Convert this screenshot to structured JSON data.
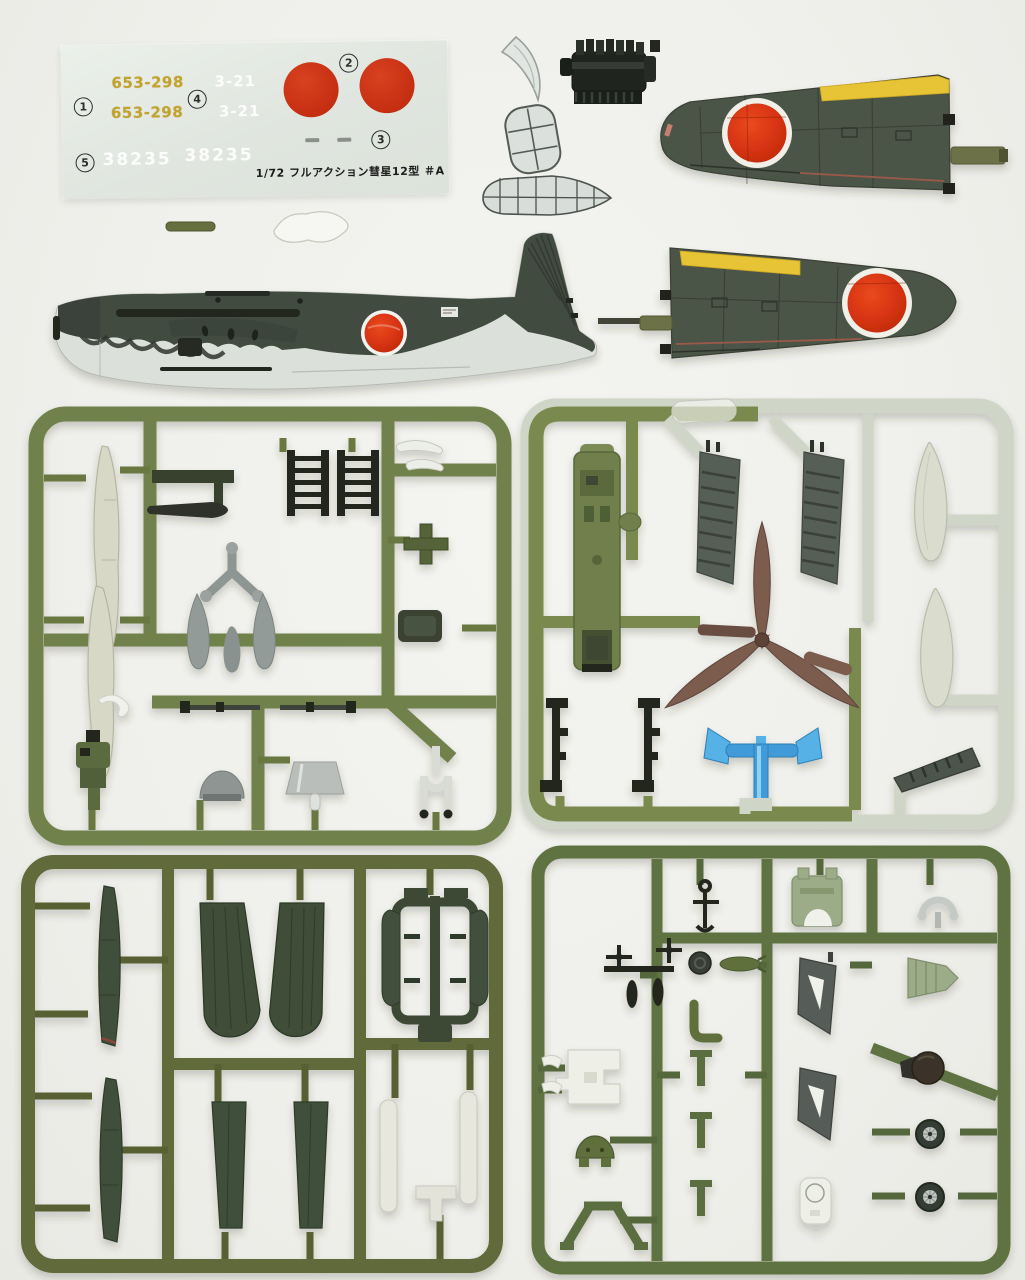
{
  "scene": {
    "description": "Contents of a 1/72 scale Japanese WWII dive bomber plastic model kit laid on a white surface",
    "colors": {
      "background": "#f1f1ed",
      "sprue_olive": "#71814c",
      "sprue_olive_dark": "#606a3a",
      "sprue_olive_mid": "#5e7342",
      "sprue_pale": "#cfd5c7",
      "airframe_green": "#4a5245",
      "leading_edge_yellow": "#e7c436",
      "hinomaru_red": "#cd3418",
      "underside_gray": "#dce0db",
      "propeller_brown": "#7b5b4e",
      "stand_blue": "#3f9fd8",
      "part_gray": "#8d9592",
      "part_cream": "#d9d9c9",
      "part_black": "#24271f"
    }
  },
  "decal_sheet": {
    "m1": "1",
    "m2": "2",
    "m3": "3",
    "m4": "4",
    "m5": "5",
    "serials": [
      "653-298",
      "653-298"
    ],
    "codes": [
      "3-21",
      "3-21"
    ],
    "tail_numbers": [
      "38235",
      "38235"
    ],
    "kit_label": "1/72 フルアクション彗星12型 ＃A",
    "colors": {
      "sheet": "#e0e6df",
      "serial_yellow": "#c2a32e",
      "roundel_red": "#c52e11",
      "faint_white": "#f4f7f3"
    }
  },
  "painted_parts": [
    "fuselage-left-half",
    "port-wing-upper-panel",
    "starboard-wing-upper-panel"
  ],
  "clear_parts": [
    "windscreen-crescent",
    "canopy-mid-section",
    "canopy-rear-cone",
    "clear-rod",
    "clear-sprue-scrap"
  ],
  "loose_parts": [
    "inline-engine-block"
  ],
  "sprues": {
    "a": {
      "color": "#71814c",
      "parts": [
        "cream-blade-1",
        "cream-blade-2",
        "dark-arm",
        "drop-tank",
        "exhaust-comb-1",
        "exhaust-comb-2",
        "white-hooks",
        "cross-bracket",
        "seat-box",
        "gear-y-strut",
        "teardrop-spat-1",
        "teardrop-spat-2",
        "small-bomb",
        "gun-rod-1",
        "gun-rod-2",
        "pilot-figure",
        "white-curl",
        "spinner-dome",
        "cone-lamp",
        "tailwheel-fork"
      ]
    },
    "b": {
      "color": "#7a8a50",
      "pale_color": "#cfd5c7",
      "parts": [
        "cockpit-tub",
        "ribbed-cover-1",
        "ribbed-cover-2",
        "three-blade-propeller",
        "prop-shaft",
        "prop-blade-spare",
        "float-tank-1",
        "float-tank-2",
        "gear-leg-1",
        "gear-leg-2",
        "blue-stand-clamp",
        "flap-wedge",
        "clear-scrap-on-runner"
      ]
    },
    "c": {
      "color": "#606a3a",
      "parts": [
        "wing-strip-1",
        "wing-strip-2",
        "flap-fan-1",
        "flap-fan-2",
        "narrow-strip-1",
        "narrow-strip-2",
        "bay-door-cluster",
        "white-strip-1",
        "white-strip-2",
        "white-tee"
      ]
    },
    "d": {
      "color": "#5e7342",
      "parts": [
        "anchor-winch",
        "engine-mount",
        "silver-c-ring",
        "bomb-prop-cluster",
        "coil-disc",
        "torpedo-small",
        "gear-bracket-1",
        "tail-cone",
        "elbow-tube",
        "white-box-bracket",
        "white-hooks",
        "green-dome",
        "tee-peg-1",
        "tee-peg-2",
        "tee-peg-3",
        "gear-bracket-2",
        "dark-ball-spinner",
        "wheel-1",
        "wheel-2",
        "white-gear-door",
        "a-frame"
      ]
    }
  }
}
